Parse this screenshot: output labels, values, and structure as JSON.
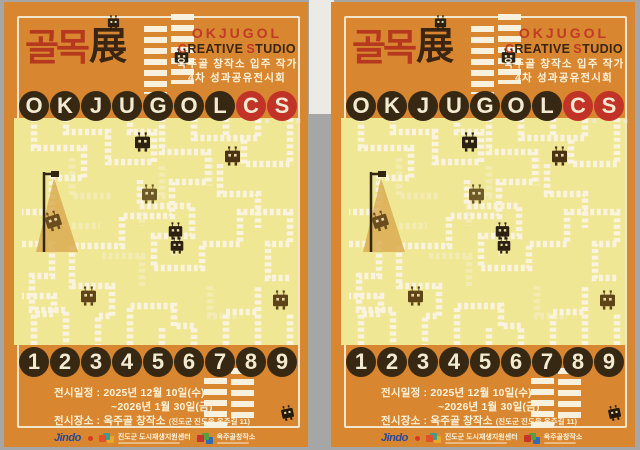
{
  "poster": {
    "title_kr": "골목",
    "title_hanja": "展",
    "studio_en": "OKJUGOL",
    "creative_c": "C",
    "creative_rest": "REATIVE",
    "studio_s": "S",
    "studio_rest": "TUDIO",
    "subtitle1": "옥주골 창작소 입주 작가",
    "subtitle2": "4차 성과공유전시회",
    "letters": [
      "O",
      "K",
      "J",
      "U",
      "G",
      "O",
      "L",
      "C",
      "S"
    ],
    "period": ".",
    "numbers": [
      "1",
      "2",
      "3",
      "4",
      "5",
      "6",
      "7",
      "8",
      "9"
    ],
    "info": {
      "line1": "전시일정 : 2025년 12월 10일(수)",
      "line2": "~2026년 1월 30일(금)",
      "line3": "전시장소 : 옥주골 창작소 ",
      "line3_detail": "(진도군 진도읍 옥주길 11)"
    },
    "logos": {
      "jindo": "Jindo",
      "center": "진도군 도시재생지원센터",
      "studio": "옥주골창작소"
    },
    "colors": {
      "poster_orange": "#d8862f",
      "title_red": "#b5381f",
      "dark_brown": "#362812",
      "circle_red": "#c23327",
      "maze_yellow": "#f0e794",
      "cream": "#f3ead2"
    }
  }
}
